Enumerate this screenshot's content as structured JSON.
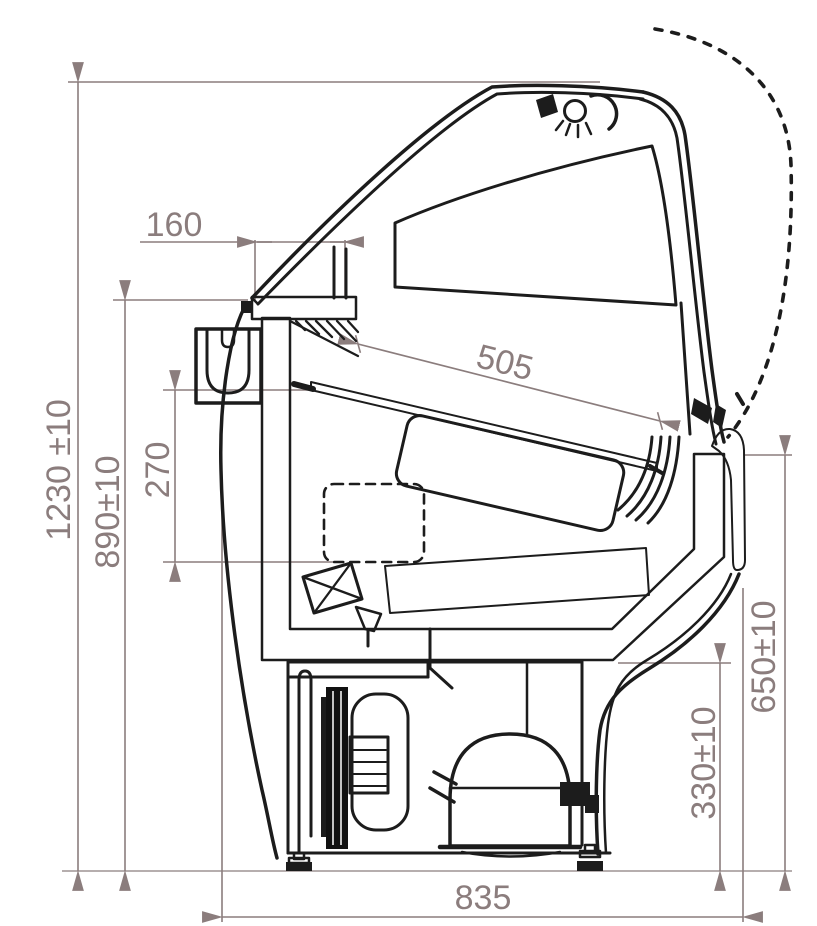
{
  "drawing": {
    "type": "technical-cross-section",
    "subject": "refrigerated serve-over display counter, side section with dimensions",
    "units": "mm",
    "dimensions": {
      "overall_height": "1230 ±10",
      "counter_height": "890±10",
      "well_depth": "270",
      "canopy_overhang": "160",
      "display_shelf_length": "505",
      "front_height": "650±10",
      "machine_compartment_height": "330±10",
      "overall_depth": "835"
    },
    "colors": {
      "dimension_gray": "#8b7d7d",
      "outline_black": "#1c1c1c",
      "body_beige": "#f8edc7",
      "bumper_tan": "#c6a483",
      "shelf_gray": "#c9c9c9",
      "glass_shelf_cyan": "#8fd2d6",
      "panel_blue": "#58b4e4"
    }
  }
}
